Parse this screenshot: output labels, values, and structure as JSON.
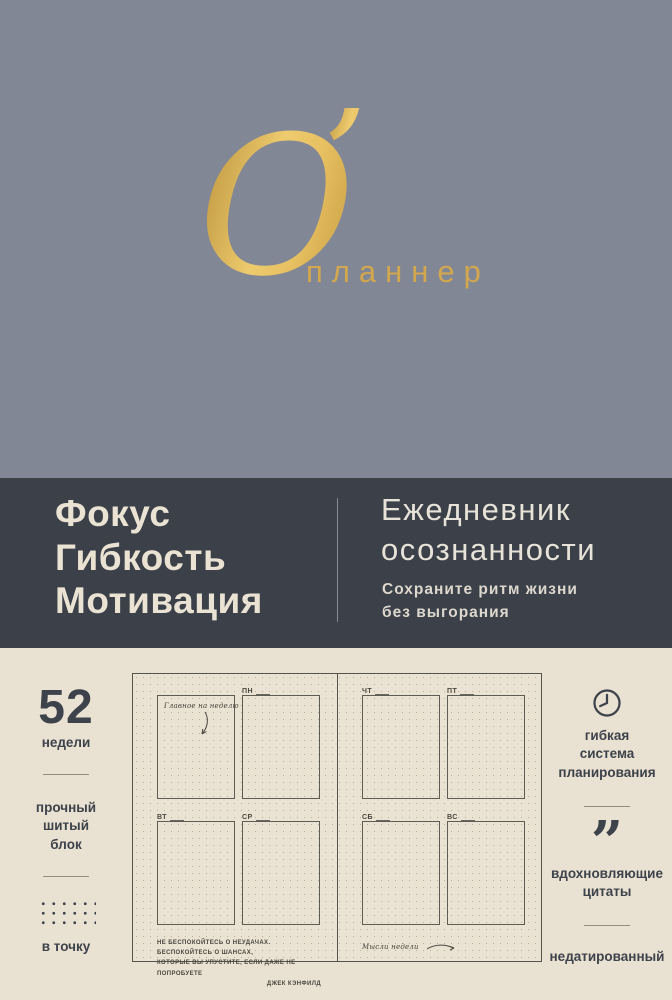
{
  "brand": {
    "initial": "O",
    "apostrophe": "’",
    "name": "планнер"
  },
  "band": {
    "keywords": "Фокус\nГибкость\nМотивация",
    "title": "Ежедневник\nосознанности",
    "subtitle": "Сохраните ритм жизни\nбез выгорания"
  },
  "features_left": {
    "weeks_number": "52",
    "weeks_label": "недели",
    "binding_label": "прочный\nшитый\nблок",
    "dots_label": "в точку"
  },
  "features_right": {
    "planning_label": "гибкая\nсистема\nпланирования",
    "quote_glyph": "”",
    "quotes_label": "вдохновляющие\nцитаты",
    "undated_label": "недатированный"
  },
  "planner": {
    "week_note": "Главное на неделю",
    "days": [
      "ПН",
      "ВТ",
      "СР",
      "ЧТ",
      "ПТ",
      "СБ",
      "ВС"
    ],
    "quote_line1": "НЕ БЕСПОКОЙТЕСЬ О НЕУДАЧАХ. БЕСПОКОЙТЕСЬ О ШАНСАХ,",
    "quote_line2": "КОТОРЫЕ ВЫ УПУСТИТЕ, ЕСЛИ ДАЖЕ НЕ ПОПРОБУЕТЕ",
    "quote_author": "Джек Кэнфилд",
    "ideas_note": "Мысли недели"
  },
  "colors": {
    "top_bg": "#828795",
    "gold": "#d7ab51",
    "band_bg": "#3b4049",
    "cream_bg": "#e9e1d1",
    "ink": "#3d424b"
  }
}
